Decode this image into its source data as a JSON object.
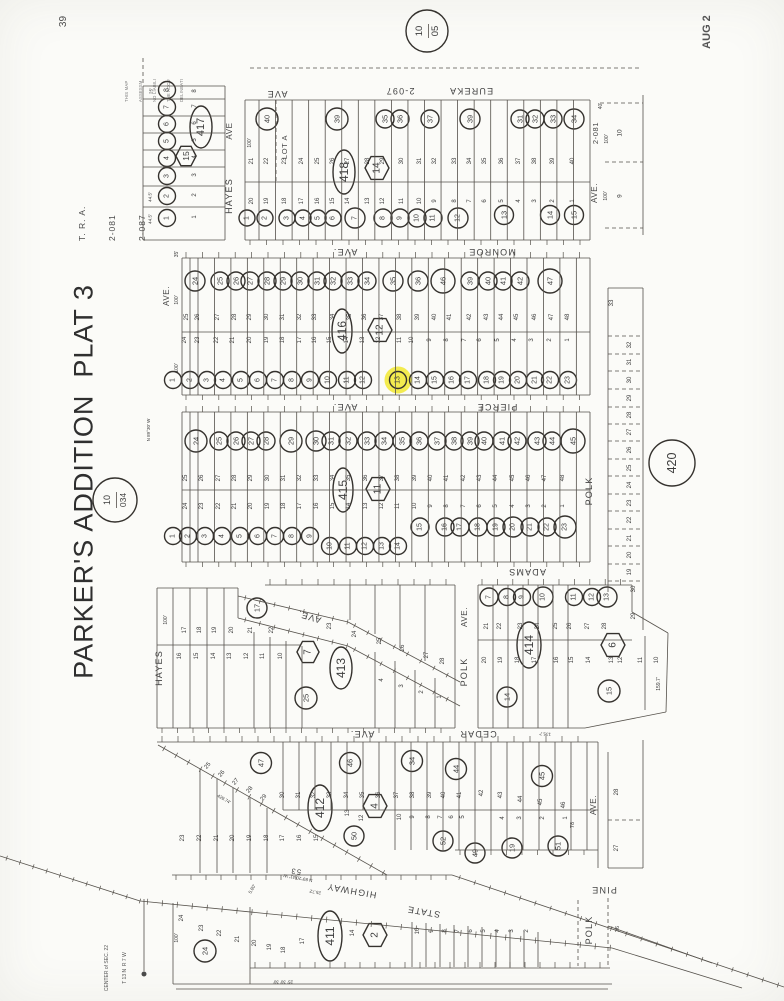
{
  "page": {
    "corner_number": "39",
    "date_stamp": "AUG 2",
    "disclaimer": [
      "THIS MAP",
      "ASSESSM",
      "NO LIABILI",
      "THE ACCU",
      "DELINEATI"
    ],
    "sheet_circle": {
      "top": "10",
      "bottom": "05"
    },
    "tra": [
      "T. R. A.",
      "2-081",
      "2-087"
    ],
    "title": "PARKER'S ADDITION  PLAT 3",
    "map_circle": {
      "top": "10",
      "bottom": "034"
    },
    "bearing": "N 89°30' W",
    "section_note": [
      "CENTER of SEC. 22",
      "T 13 N  R 7 W"
    ]
  },
  "streets": {
    "eureka": "EUREKA",
    "eureka_tra": "2-097",
    "eureka_ave": "AVE",
    "monroe": "MONROE",
    "monroe_ave": "AVE.",
    "pierce": "PIERCE",
    "pierce_ave": "AVE.",
    "adams": "ADAMS",
    "adams_ave": "AVE.",
    "cedar": "CEDAR",
    "cedar_ave": "AVE.",
    "pine": "PINE",
    "pine_ave": "AVE.",
    "state": "STATE",
    "highway": "HIGHWAY",
    "hwy_no": "53",
    "hayes_n": "HAYES",
    "hayes_n_ave": "AVE",
    "hayes_s": "HAYES",
    "west_ave": "AVE.",
    "polk_mid": "POLK",
    "polk_mid_ave": "AVE.",
    "polk_e": "POLK",
    "polk_s": "POLK",
    "tra_e": "2-081",
    "ave_e": "AVE."
  },
  "blocks": {
    "b417": {
      "oval": "417",
      "hex": "15",
      "circles": [
        "8",
        "7",
        "6",
        "5",
        "4",
        "3",
        "2",
        "1"
      ],
      "lots": [
        "8",
        "7",
        "6",
        "5",
        "4",
        "3",
        "2",
        "1"
      ]
    },
    "b418": {
      "oval": "418",
      "hex": "14",
      "lot_a": "LOT A",
      "top_circles": [
        "40",
        "39",
        "35",
        "36",
        "37",
        "39",
        "31",
        "32",
        "33",
        "34"
      ],
      "top_lots": [
        "21",
        "22",
        "23",
        "24",
        "25",
        "26",
        "27",
        "28",
        "29",
        "30",
        "31",
        "32",
        "33",
        "34",
        "35",
        "36",
        "37",
        "38",
        "39",
        "40"
      ],
      "bottom_lots": [
        "20",
        "19",
        "18",
        "17",
        "16",
        "15",
        "14",
        "13",
        "12",
        "11",
        "10",
        "9",
        "8",
        "7",
        "6",
        "5",
        "4",
        "3",
        "2",
        "1"
      ],
      "bc_a": [
        "1",
        "2",
        "3",
        "4",
        "5",
        "6",
        "7",
        "8",
        "9",
        "10",
        "11",
        "12"
      ],
      "bc_b": [
        "13",
        "14",
        "15"
      ]
    },
    "b416": {
      "oval": "416",
      "hex": "12",
      "top_circles": [
        "24",
        "25",
        "26",
        "27",
        "28",
        "29",
        "30",
        "31",
        "32",
        "33",
        "34",
        "35",
        "36",
        "46",
        "39",
        "40",
        "41",
        "42",
        "47"
      ],
      "upper_lots": [
        "25",
        "26",
        "27",
        "28",
        "29",
        "30",
        "31",
        "32",
        "33",
        "34",
        "35",
        "36",
        "37",
        "38",
        "39",
        "40",
        "41",
        "42",
        "43",
        "44",
        "45",
        "46",
        "47",
        "48"
      ],
      "lower_lots": [
        "24",
        "23",
        "22",
        "21",
        "20",
        "19",
        "18",
        "17",
        "16",
        "15",
        "14",
        "13",
        "12",
        "11",
        "10",
        "9",
        "8",
        "7",
        "6",
        "5",
        "4",
        "3",
        "2",
        "1"
      ],
      "bottom_circles": [
        "1",
        "2",
        "3",
        "4",
        "5",
        "6",
        "7",
        "8",
        "9",
        "10",
        "11",
        "12",
        "13",
        "14",
        "15",
        "16",
        "17",
        "18",
        "19",
        "20",
        "21",
        "22",
        "23"
      ],
      "highlighted_lot": "13"
    },
    "b415": {
      "oval": "415",
      "hex": "11",
      "top_circles": [
        "24",
        "25",
        "26",
        "27",
        "28",
        "29",
        "30",
        "31",
        "32",
        "33",
        "34",
        "35",
        "36",
        "37",
        "38",
        "39",
        "40",
        "41",
        "42",
        "43",
        "44",
        "45"
      ],
      "upper_lots": [
        "25",
        "26",
        "27",
        "28",
        "29",
        "30",
        "31",
        "32",
        "33",
        "34",
        "35",
        "36",
        "37",
        "38",
        "39",
        "40",
        "41",
        "42",
        "43",
        "44",
        "45",
        "46",
        "47",
        "48"
      ],
      "lower_lots": [
        "24",
        "23",
        "22",
        "21",
        "20",
        "19",
        "18",
        "17",
        "16",
        "15",
        "14",
        "13",
        "12",
        "11",
        "10",
        "9",
        "8",
        "7",
        "6",
        "5",
        "4",
        "3",
        "2",
        "1"
      ],
      "bc_a": [
        "1",
        "2",
        "3",
        "4",
        "5",
        "6",
        "7",
        "8",
        "9"
      ],
      "bc_b": [
        "10",
        "11",
        "12",
        "13",
        "14"
      ],
      "bc_c": [
        "15",
        "16",
        "17",
        "18",
        "19",
        "20",
        "21",
        "22",
        "23"
      ]
    },
    "b413": {
      "oval": "413",
      "hex": "7",
      "c17": "17",
      "c25": "25",
      "top_lots": [
        "17",
        "18",
        "19",
        "20",
        "21",
        "22"
      ],
      "wedge_lots": [
        "23",
        "24",
        "25",
        "26",
        "27",
        "28"
      ],
      "bot_lots_a": [
        "16",
        "15",
        "14",
        "13",
        "12",
        "11",
        "10"
      ],
      "bot_lots_b": [
        "4",
        "3",
        "2",
        "1"
      ]
    },
    "b414": {
      "oval": "414",
      "hex": "6",
      "c14": "14",
      "c15": "15",
      "top_circles": [
        "7",
        "8",
        "9",
        "10",
        "11",
        "12",
        "13"
      ],
      "upper_lots": [
        "21",
        "22",
        "23",
        "24",
        "25",
        "26",
        "27",
        "28"
      ],
      "lower_lots": [
        "20",
        "19",
        "18",
        "17",
        "16",
        "15",
        "14",
        "13",
        "12",
        "11",
        "10"
      ],
      "right_lots": [
        "30",
        "29"
      ]
    },
    "b412": {
      "oval": "412",
      "hex": "4",
      "top_circles": [
        "47",
        "46",
        "34",
        "44",
        "45"
      ],
      "bottom_circles": [
        "50",
        "52",
        "49",
        "19",
        "51"
      ],
      "up_a": [
        "25",
        "26",
        "27",
        "28",
        "29"
      ],
      "up_b": [
        "30",
        "31",
        "32",
        "33",
        "34",
        "35",
        "36",
        "37",
        "38",
        "39",
        "40",
        "41"
      ],
      "up_c": [
        "42",
        "43",
        "44",
        "45",
        "46"
      ],
      "low_a": [
        "23",
        "22",
        "21",
        "20",
        "19",
        "18",
        "17",
        "16",
        "15"
      ],
      "low_b": [
        "13",
        "12"
      ],
      "low_c": [
        "10",
        "9",
        "8",
        "7",
        "6",
        "5"
      ],
      "low_d": [
        "4",
        "3",
        "2",
        "1"
      ]
    },
    "b411": {
      "oval": "411",
      "hex": "2",
      "c24": "24",
      "lot14": "14",
      "lots_left": [
        "24",
        "23",
        "22",
        "21",
        "20",
        "19",
        "18",
        "17"
      ],
      "lots_right": [
        "10",
        "9",
        "8",
        "7",
        "6",
        "5",
        "4",
        "3",
        "2"
      ]
    },
    "b420": {
      "circle": "420",
      "top_lot": "33",
      "lots": [
        "32",
        "31",
        "30",
        "29",
        "28",
        "27",
        "26",
        "25",
        "24",
        "23",
        "22",
        "21",
        "20",
        "19"
      ]
    },
    "strip_e": {
      "lots": [
        "10",
        "9"
      ]
    },
    "strip_pine": {
      "lots": [
        "28",
        "27"
      ]
    }
  },
  "annot": {
    "n40": "40'",
    "h100a": "100'",
    "h100b": "100'",
    "h100c": "100'",
    "h100d": "100'",
    "h100e": "100'",
    "h100f": "100'",
    "h100g": "100'",
    "d445a": "44.5'",
    "d445b": "44.5'",
    "d25": "25'",
    "d35": "35'",
    "d1597": "159.7'",
    "d1357": "135.7'",
    "d78": "78",
    "d58": "5.80'",
    "brg2": "N 89°20'41\" W",
    "d2572": "25.72'",
    "dticks": "25' 30' 30'",
    "d42974": "429.74'",
    "lot26": "26"
  }
}
